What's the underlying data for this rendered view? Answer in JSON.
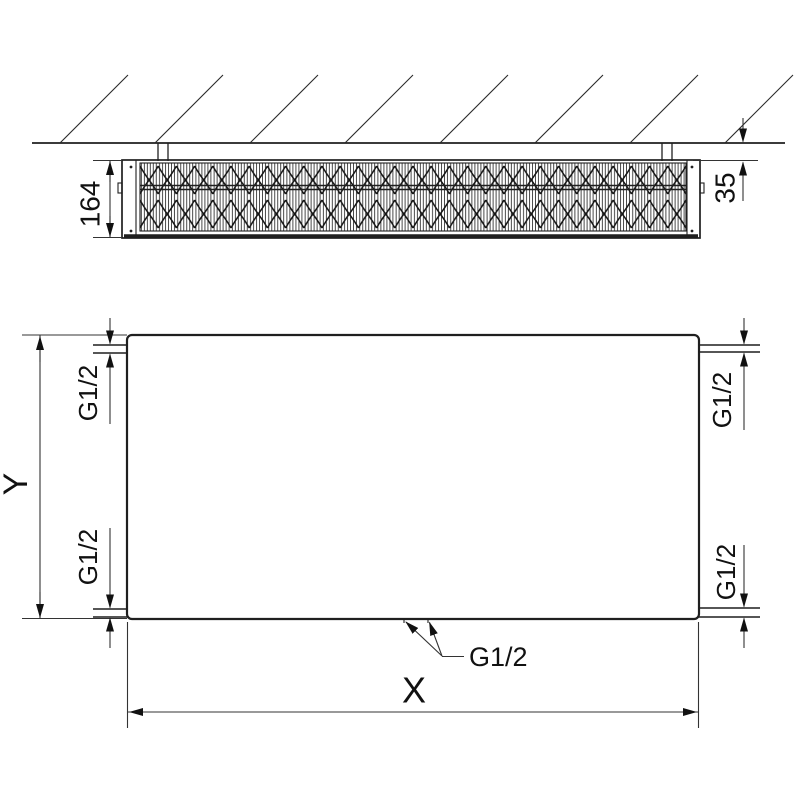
{
  "drawing": {
    "top_view": {
      "depth_dimension": "164",
      "wall_distance_dimension": "35"
    },
    "front_view": {
      "height_dimension": "Y",
      "width_dimension": "X",
      "connections": {
        "top_left": "G1/2",
        "top_right": "G1/2",
        "bottom_left": "G1/2",
        "bottom_right": "G1/2",
        "bottom_center": "G1/2"
      }
    },
    "colors": {
      "line": "#1f1f1f",
      "dimension_line": "#333333",
      "background": "#ffffff"
    }
  }
}
